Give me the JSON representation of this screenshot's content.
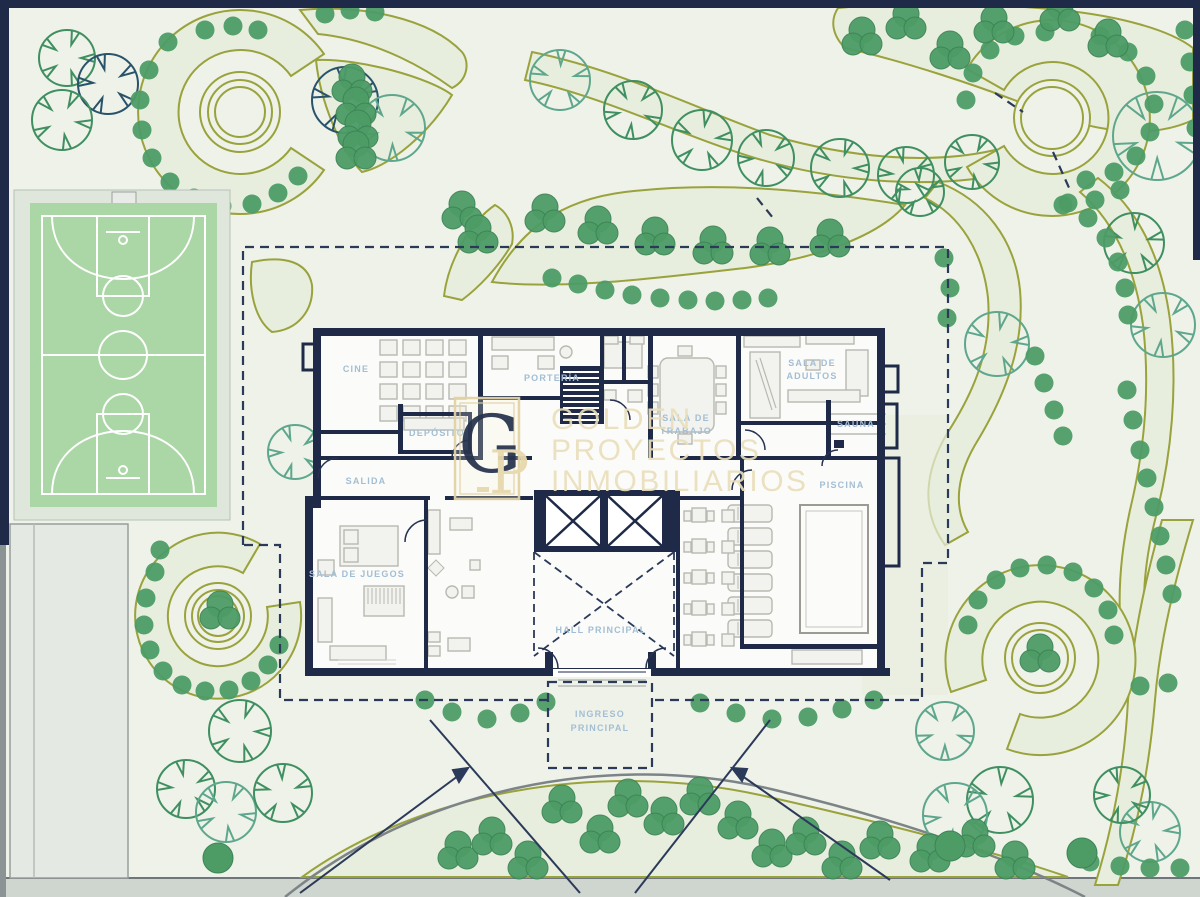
{
  "labels": {
    "cine": "CINE",
    "porteria": "PORTERÍA",
    "deposito": "DEPÓSITO",
    "salida": "SALIDA",
    "sala_trabajo_l1": "SALA DE",
    "sala_trabajo_l2": "TRABAJO",
    "sala_adultos_l1": "SALA DE",
    "sala_adultos_l2": "ADULTOS",
    "sauna": "SAUNA",
    "piscina": "PISCINA",
    "sala_juegos": "SALA DE JUEGOS",
    "hall": "HALL PRINCIPAL",
    "ingreso_l1": "INGRESO",
    "ingreso_l2": "PRINCIPAL"
  },
  "watermark": {
    "monogram_top": "G",
    "monogram_bottom": "P",
    "line1": "GOLDEN",
    "line2": "PROYECTOS",
    "line3": "INMOBILIARIOS"
  },
  "colors": {
    "background": "#eef2e9",
    "wall_navy": "#1e2a47",
    "bed_olive": "#9aa23c",
    "bed_fill": "#e8eedd",
    "shrub_green": "#4d9c66",
    "tree_green": "#3f8f61",
    "tree_teal": "#5ea78d",
    "tree_dark": "#29536b",
    "court_green": "#abd6a6",
    "court_line": "#ffffff",
    "label_blue": "#a2bed4",
    "watermark_cream": "#eadfbb",
    "street_gray": "#cfd5cf"
  }
}
